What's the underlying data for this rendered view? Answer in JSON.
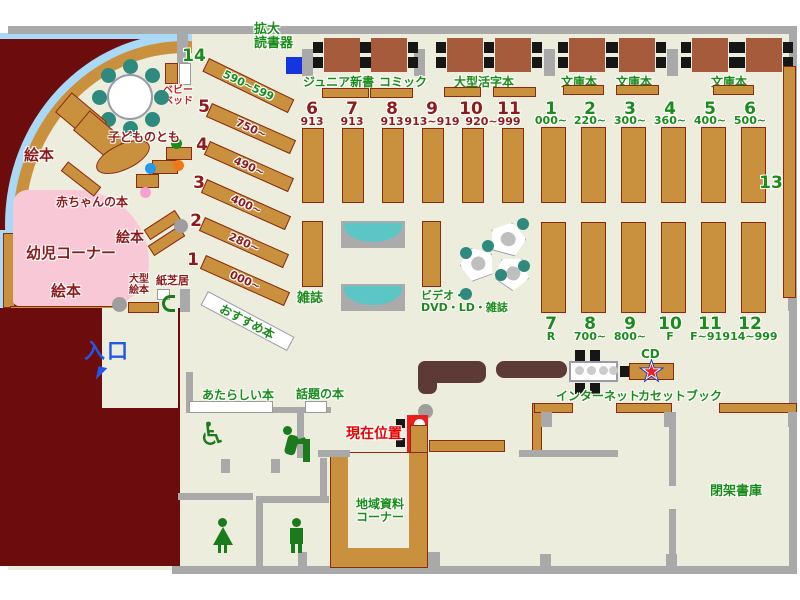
{
  "colors": {
    "floor_beige": "#EDEDDE",
    "exterior_dark_red": "#6D0C0C",
    "wall_gray": "#A9A9A9",
    "shelf_brown": "#C9913E",
    "table_brown": "#A65B3D",
    "counter_maroon": "#5E3A36",
    "accent_green": "#1A8C1A",
    "label_dark_red": "#8E1A1A",
    "highlight_red": "#E80000",
    "entrance_blue": "#2456E8",
    "glass_light_blue": "#A9D9F7",
    "toddler_pink": "#F8C8D6",
    "chair_teal": "#2E8A7E",
    "bench_teal": "#5CC6C6",
    "device_blue": "#1535E0",
    "marker_red": "#EE1C1C"
  },
  "top_area": {
    "magnifier_line1": "拡大",
    "magnifier_line2": "読書器",
    "shelf_labels": [
      "ジュニア新書",
      "コミック",
      "大型活字本",
      "文庫本",
      "文庫本",
      "文庫本"
    ]
  },
  "children_corner": {
    "baby_bed_line1": "ベビー",
    "baby_bed_line2": "ベッド",
    "kodomo_tomo": "子どものとも",
    "ehon_left": "絵本",
    "ehon_mid": "絵本",
    "ehon_bottom": "絵本",
    "baby_books": "赤ちゃんの本",
    "corner_name": "幼児コーナー",
    "large_ehon_line1": "大型",
    "large_ehon_line2": "絵本",
    "kamishibai": "紙芝居",
    "osusume": "おすすめ本"
  },
  "diagonal_shelves": [
    {
      "n": "14",
      "range": "590~599"
    },
    {
      "n": "5",
      "range": "750~"
    },
    {
      "n": "4",
      "range": "490~"
    },
    {
      "n": "3",
      "range": "400~"
    },
    {
      "n": "2",
      "range": "280~"
    },
    {
      "n": "1",
      "range": "000~"
    }
  ],
  "center_shelves": {
    "numbers": [
      "6",
      "7",
      "8",
      "9",
      "10",
      "11"
    ],
    "ranges": [
      "913",
      "913",
      "913",
      "913~919"
    ],
    "shared_range": "920~999",
    "zasshi": "雑誌",
    "av_line1": "ビデオ・",
    "av_line2": "DVD・LD・雑誌"
  },
  "right_shelves": {
    "top": [
      [
        "1",
        "000~"
      ],
      [
        "2",
        "220~"
      ],
      [
        "3",
        "300~"
      ],
      [
        "4",
        "360~"
      ],
      [
        "5",
        "400~"
      ],
      [
        "6",
        "500~"
      ]
    ],
    "bottom": [
      [
        "7",
        "R"
      ],
      [
        "8",
        "700~"
      ],
      [
        "9",
        "800~"
      ],
      [
        "10",
        "F"
      ],
      [
        "11",
        "F~914"
      ],
      [
        "12",
        "914~999"
      ]
    ],
    "wall_shelf": "13"
  },
  "entrance": {
    "label": "入口"
  },
  "info_shelves": {
    "new_books": "あたらしい本",
    "topic_books": "話題の本"
  },
  "current_location": {
    "label": "現在位置"
  },
  "av_corner": {
    "internet": "インターネット",
    "cd": "CD",
    "cassette": "カセットブック"
  },
  "rooms": {
    "local_line1": "地域資料",
    "local_line2": "コーナー",
    "closed_stack": "閉架書庫"
  }
}
